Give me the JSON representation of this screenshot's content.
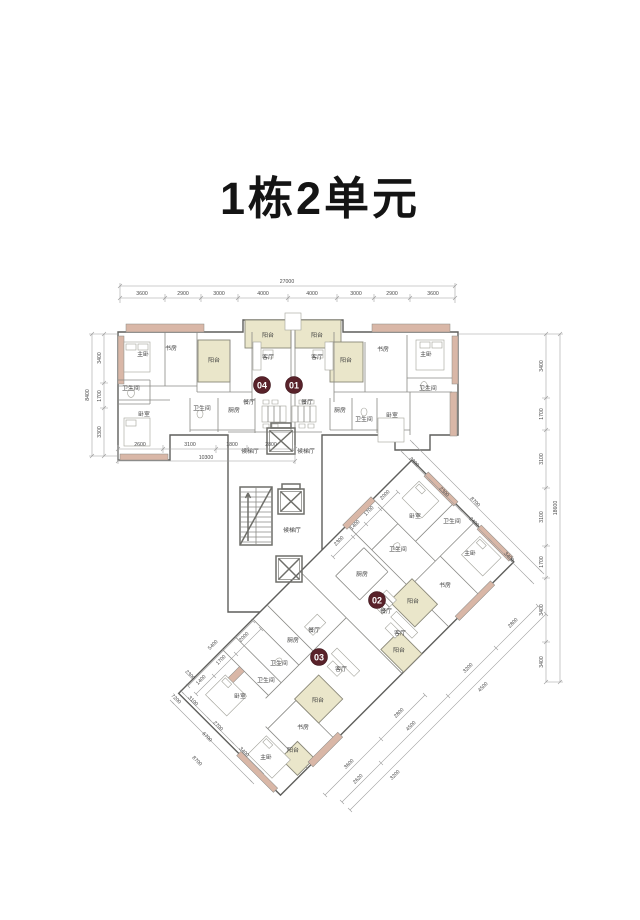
{
  "title": "1栋2单元",
  "colors": {
    "balcony_fill": "#eae6ca",
    "exterior_wall_accent": "#d9b7a7",
    "unit_badge": "#59222a",
    "line": "#5f5f5c",
    "dim_text": "#4a4a4a"
  },
  "core": {
    "lobby": "候梯厅"
  },
  "units": [
    {
      "no": "04",
      "rooms": [
        "主卧",
        "书房",
        "阳台",
        "客厅",
        "卫生间",
        "卧室",
        "卫生间",
        "厨房",
        "餐厅",
        "阳台"
      ]
    },
    {
      "no": "01",
      "rooms": [
        "阳台",
        "书房",
        "主卧",
        "客厅",
        "卫生间",
        "厨房",
        "卫生间",
        "卧室",
        "餐厅",
        "阳台"
      ]
    },
    {
      "no": "02",
      "rooms": [
        "卧室",
        "卫生间",
        "卫生间",
        "主卧",
        "书房",
        "厨房",
        "餐厅",
        "客厅",
        "阳台",
        "阳台"
      ]
    },
    {
      "no": "03",
      "rooms": [
        "厨房",
        "餐厅",
        "卫生间",
        "卫生间",
        "卧室",
        "客厅",
        "阳台",
        "书房",
        "主卧",
        "阳台"
      ]
    }
  ],
  "dims": {
    "top": {
      "total": "27000",
      "segments": [
        "3600",
        "2900",
        "3000",
        "4000",
        "4000",
        "3000",
        "2900",
        "3600"
      ]
    },
    "left": {
      "total": "8400",
      "segments": [
        "3400",
        "1700",
        "3300"
      ]
    },
    "bottom": {
      "total": "10300",
      "segments": [
        "2600",
        "3100",
        "1800",
        "2800"
      ]
    },
    "right": {
      "total": "18600",
      "segments": [
        "3400",
        "1700",
        "3100",
        "3100",
        "1700",
        "3400",
        "3400"
      ]
    },
    "diag_ne": {
      "total": "8700",
      "segments": [
        "2300",
        "2300",
        "2400",
        "3400"
      ]
    },
    "diag_se": {
      "segments": [
        "2800",
        "3200",
        "4500",
        "2620",
        "4500",
        "3200"
      ]
    },
    "diag_nw": {
      "total": "5400",
      "segments": [
        "2300",
        "1400",
        "1700",
        "2000",
        "1400",
        "1700",
        "2000"
      ]
    },
    "diag_sw": {
      "total": "6700",
      "segments": [
        "3100",
        "2700",
        "3400",
        "2300",
        "7200",
        "8700",
        "3600",
        "2800"
      ]
    }
  }
}
